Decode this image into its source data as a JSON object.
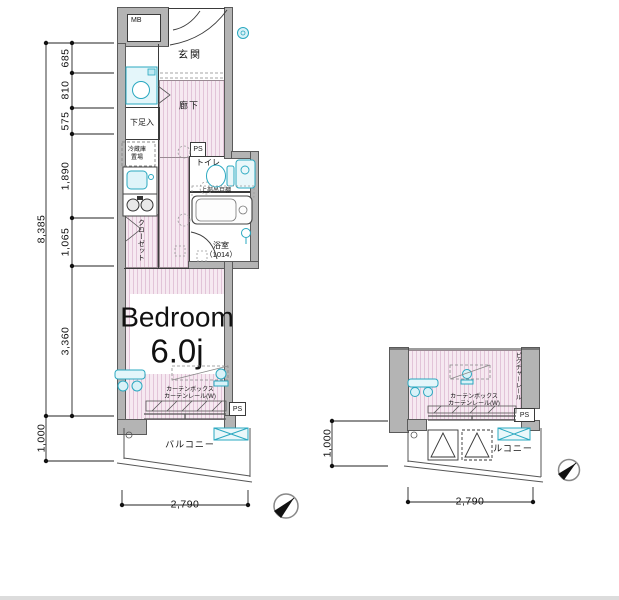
{
  "colors": {
    "wall_gray": "#b4b4b4",
    "floor_pink": "#f6e9f1",
    "floor_pink_stripe": "#e2c4d8",
    "fixture_cyan": "#2aa8c0",
    "fixture_cyan_fill": "#e4f6fa",
    "line_black": "#333333"
  },
  "main_plan": {
    "mb": "MB",
    "genkan": "玄関",
    "washer": {
      "line1": "洗濯機",
      "line2": "置場"
    },
    "shoe_box": "下足入",
    "fridge": {
      "line1": "冷蔵庫",
      "line2": "置場"
    },
    "hallway": "廊下",
    "ps_upper": "PS",
    "toilet": "トイレ",
    "upper_cabinet": "上部吊戸棚",
    "bathroom": {
      "line1": "浴室",
      "line2": "（1014）"
    },
    "closet": "クローゼット",
    "bedroom": {
      "name": "Bedroom",
      "size": "6.0j"
    },
    "curtain": {
      "line1": "カーテンボックス",
      "line2": "カーテンレール(W)"
    },
    "ps_lower": "PS",
    "balcony": "バルコニー",
    "dims": {
      "overall_height": "8,385",
      "seg1": "685",
      "seg2": "810",
      "seg3": "575",
      "seg4": "1,890",
      "seg5": "1,065",
      "seg6": "3,360",
      "balcony_depth": "1,000",
      "width": "2,790"
    }
  },
  "small_plan": {
    "picture_rail": "ピクチャーレール",
    "curtain": {
      "line1": "カーテンボックス",
      "line2": "カーテンレール(W)"
    },
    "ps": "PS",
    "balcony": "バルコニー",
    "hatch_left": {
      "line1": "避難ハッチ",
      "line2": "（2・4・6F）"
    },
    "hatch_right": {
      "line1": "避難ハッチ",
      "line2": "（7F）"
    },
    "dims": {
      "balcony_depth": "1,000",
      "width": "2,790"
    }
  }
}
